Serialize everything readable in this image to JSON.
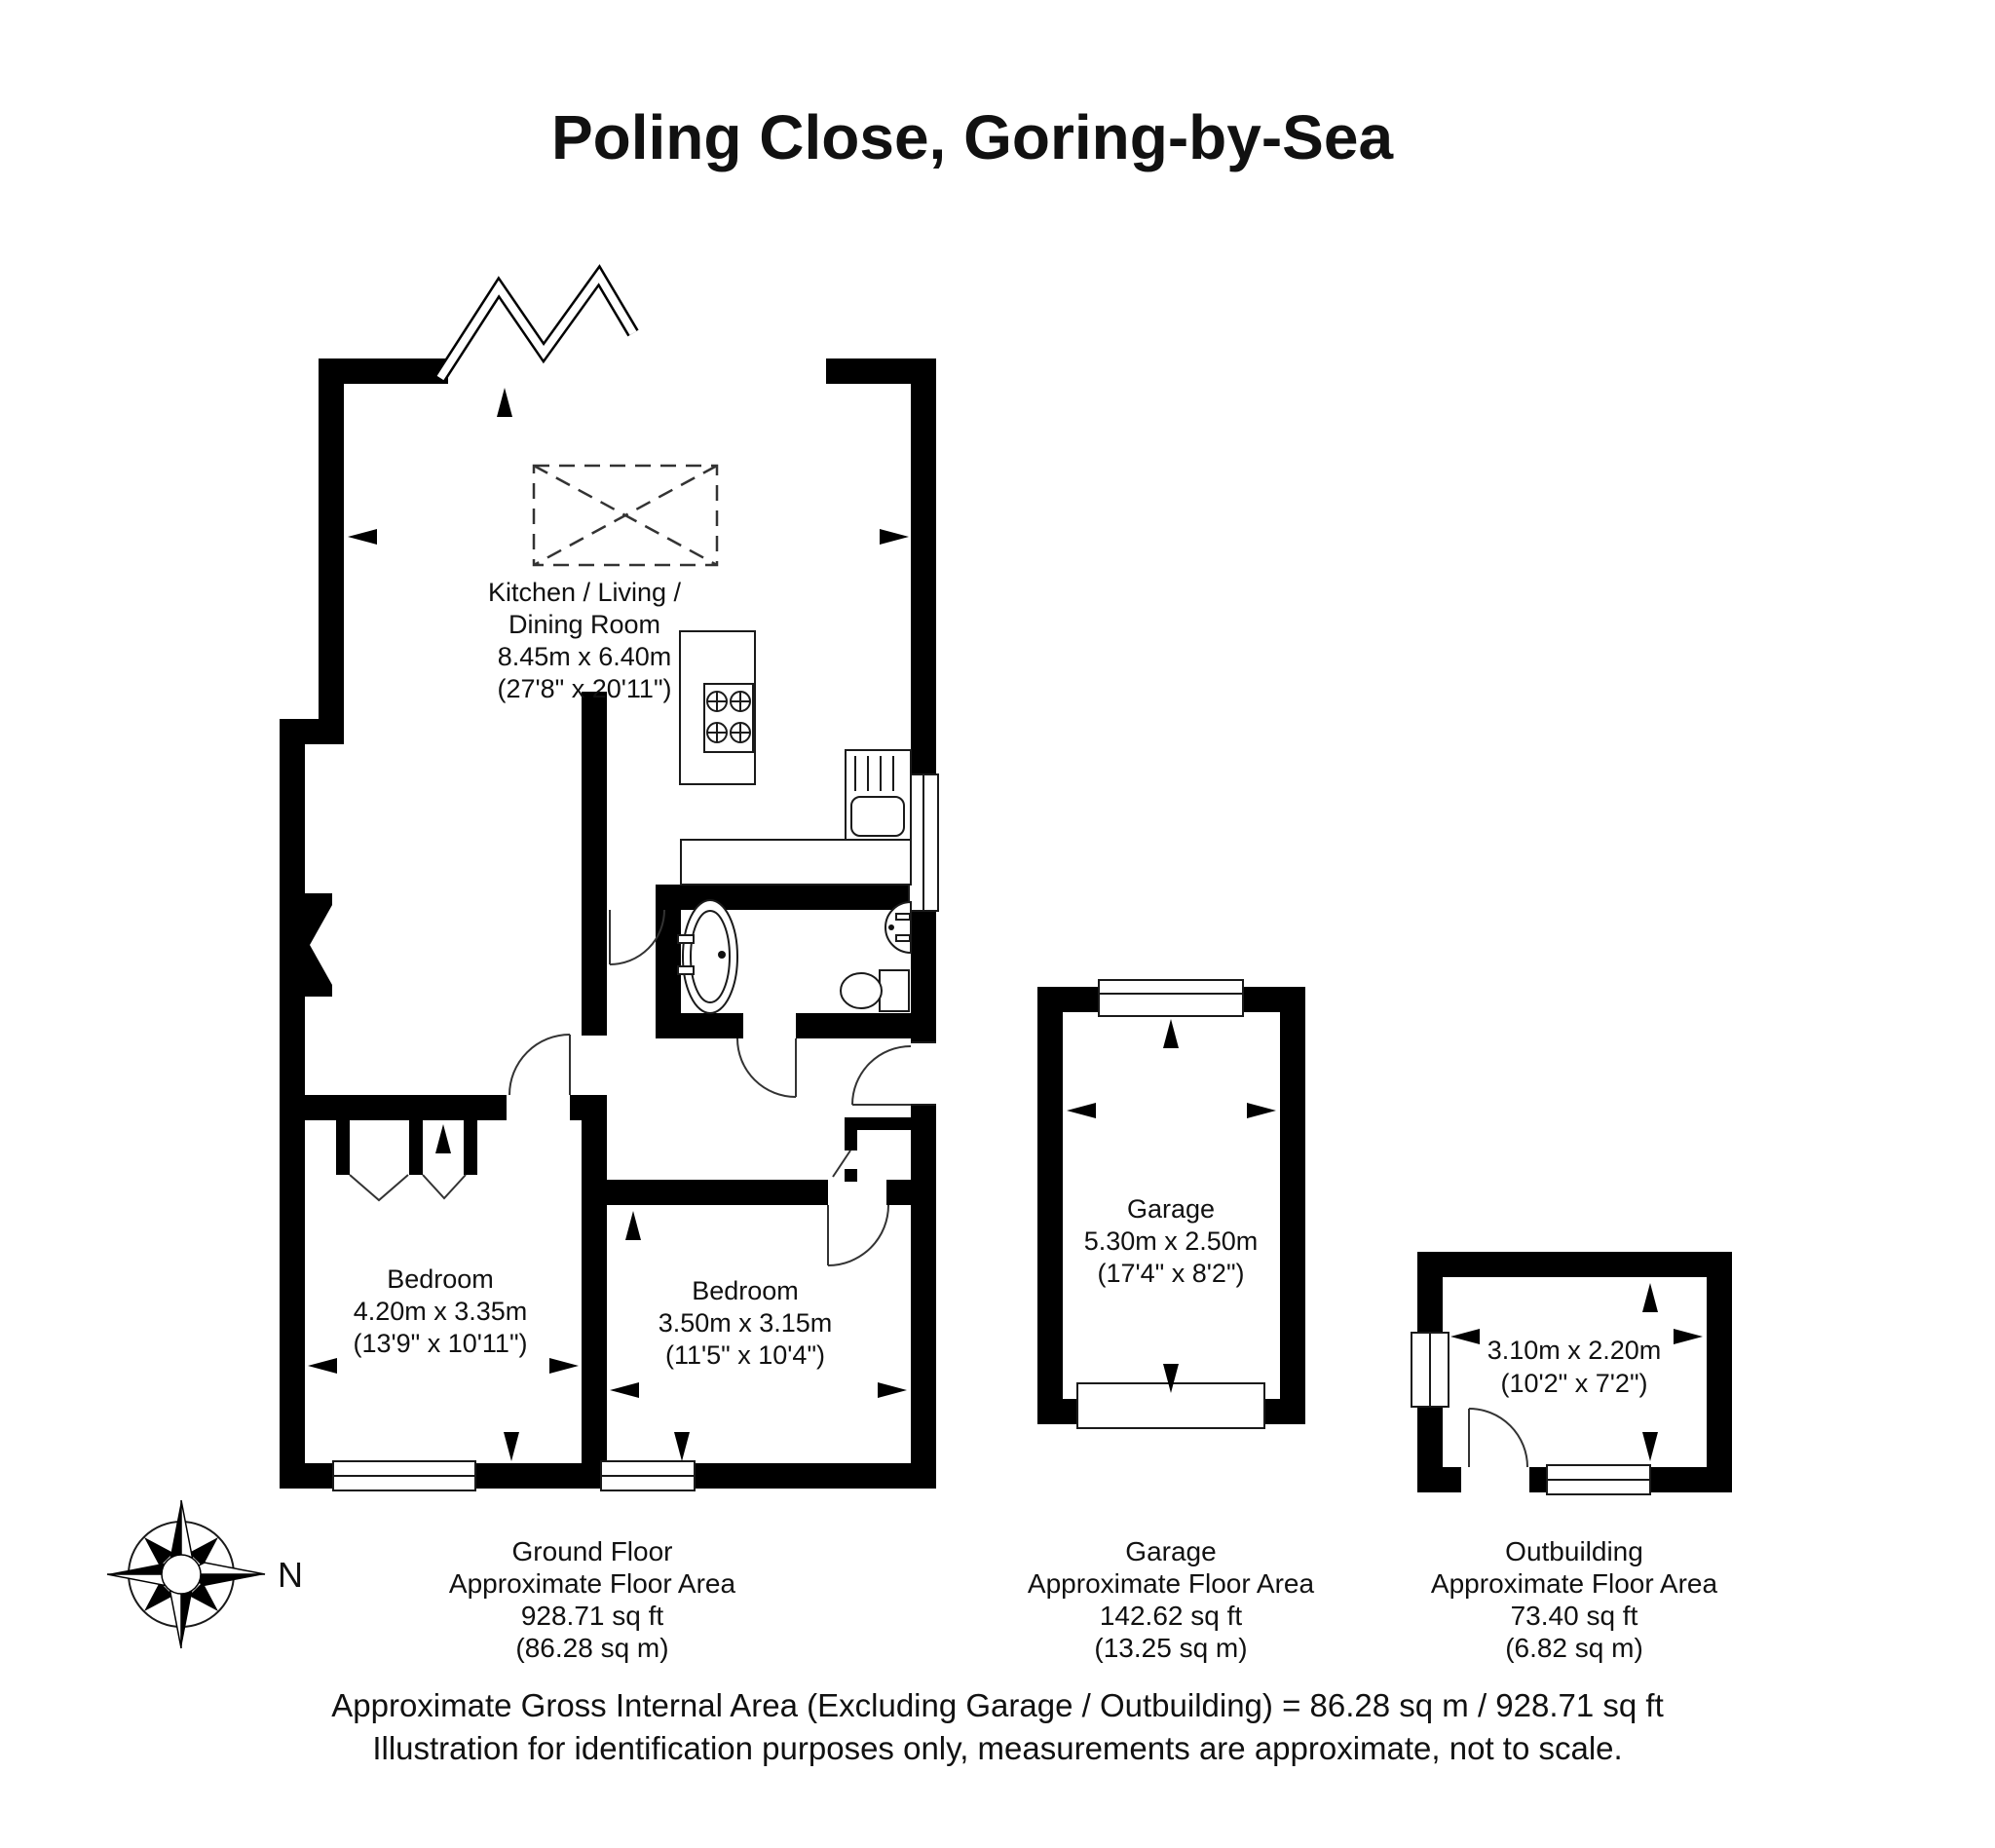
{
  "title": "Poling Close, Goring-by-Sea",
  "rooms": {
    "kitchen": {
      "line1": "Kitchen / Living /",
      "line2": "Dining Room",
      "metric": "8.45m x 6.40m",
      "imperial": "(27'8\" x 20'11\")"
    },
    "bedroom1": {
      "name": "Bedroom",
      "metric": "4.20m x 3.35m",
      "imperial": "(13'9\" x 10'11\")"
    },
    "bedroom2": {
      "name": "Bedroom",
      "metric": "3.50m x 3.15m",
      "imperial": "(11'5\" x 10'4\")"
    },
    "garage": {
      "name": "Garage",
      "metric": "5.30m x 2.50m",
      "imperial": "(17'4\" x 8'2\")"
    },
    "outbuilding": {
      "metric": "3.10m x 2.20m",
      "imperial": "(10'2\" x 7'2\")"
    }
  },
  "area_blocks": {
    "ground_floor": {
      "title": "Ground Floor",
      "subtitle": "Approximate Floor Area",
      "sqft": "928.71 sq ft",
      "sqm": "(86.28 sq m)"
    },
    "garage": {
      "title": "Garage",
      "subtitle": "Approximate Floor Area",
      "sqft": "142.62 sq ft",
      "sqm": "(13.25 sq m)"
    },
    "outbuilding": {
      "title": "Outbuilding",
      "subtitle": "Approximate Floor Area",
      "sqft": "73.40 sq ft",
      "sqm": "(6.82 sq m)"
    }
  },
  "footer": {
    "line1": "Approximate Gross Internal Area (Excluding Garage / Outbuilding) = 86.28 sq m / 928.71 sq ft",
    "line2": "Illustration for identification purposes only, measurements are approximate, not to scale."
  },
  "compass": {
    "north_label": "N"
  }
}
